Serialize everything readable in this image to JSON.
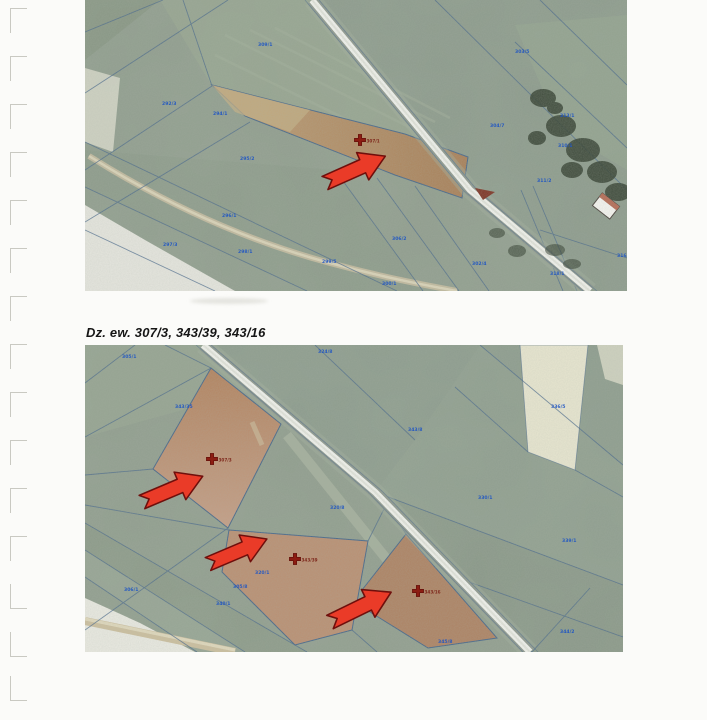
{
  "page": {
    "background": "#fbfbf9",
    "caption": "Dz. ew. 307/3, 343/39, 343/16"
  },
  "colors": {
    "field_green": "#8f9c8d",
    "boundary_blue": "#47678a",
    "parcel_number_blue": "#1e55c4",
    "highlight_brown": "#b5886a",
    "arrow_red": "#ea3b28",
    "arrow_outline": "#6f0f0c",
    "cross_dark_red": "#8c1d12",
    "road_white": "#f2f3ee"
  },
  "top_map": {
    "description": "aerial orthophoto with cadastral parcel boundaries, one highlighted parcel with red cross marker and red arrow",
    "markers": [
      {
        "label": "307/1",
        "x": 275,
        "y": 140
      }
    ],
    "arrows": [
      {
        "x": 240,
        "y": 183,
        "angle": -24,
        "len": 66
      }
    ],
    "parcel_labels": [
      {
        "t": "309/1",
        "x": 173,
        "y": 46
      },
      {
        "t": "294/1",
        "x": 128,
        "y": 115
      },
      {
        "t": "292/3",
        "x": 77,
        "y": 105
      },
      {
        "t": "295/2",
        "x": 155,
        "y": 160
      },
      {
        "t": "296/1",
        "x": 137,
        "y": 217
      },
      {
        "t": "297/3",
        "x": 78,
        "y": 246
      },
      {
        "t": "298/1",
        "x": 153,
        "y": 253
      },
      {
        "t": "299/5",
        "x": 237,
        "y": 263
      },
      {
        "t": "306/2",
        "x": 307,
        "y": 240
      },
      {
        "t": "300/1",
        "x": 297,
        "y": 285
      },
      {
        "t": "302/4",
        "x": 387,
        "y": 265
      },
      {
        "t": "318/1",
        "x": 465,
        "y": 275
      },
      {
        "t": "303/5",
        "x": 430,
        "y": 53
      },
      {
        "t": "313/1",
        "x": 475,
        "y": 117
      },
      {
        "t": "304/7",
        "x": 405,
        "y": 127
      },
      {
        "t": "310/1",
        "x": 473,
        "y": 147
      },
      {
        "t": "311/2",
        "x": 452,
        "y": 182
      },
      {
        "t": "316/1",
        "x": 532,
        "y": 257
      }
    ]
  },
  "bottom_map": {
    "description": "aerial orthophoto with cadastral parcel boundaries, three highlighted parcels with red cross markers and red arrows",
    "markers": [
      {
        "label": "307/3",
        "x": 127,
        "y": 114
      },
      {
        "label": "343/39",
        "x": 210,
        "y": 214
      },
      {
        "label": "343/16",
        "x": 333,
        "y": 246
      }
    ],
    "arrows": [
      {
        "x": 57,
        "y": 157,
        "angle": -23,
        "len": 66
      },
      {
        "x": 123,
        "y": 219,
        "angle": -23,
        "len": 64
      },
      {
        "x": 245,
        "y": 277,
        "angle": -26,
        "len": 68
      }
    ],
    "parcel_labels": [
      {
        "t": "305/1",
        "x": 37,
        "y": 13
      },
      {
        "t": "324/8",
        "x": 233,
        "y": 8
      },
      {
        "t": "343/35",
        "x": 90,
        "y": 63
      },
      {
        "t": "343/8",
        "x": 323,
        "y": 86
      },
      {
        "t": "336/5",
        "x": 466,
        "y": 63
      },
      {
        "t": "330/1",
        "x": 393,
        "y": 154
      },
      {
        "t": "339/1",
        "x": 477,
        "y": 197
      },
      {
        "t": "320/8",
        "x": 245,
        "y": 164
      },
      {
        "t": "320/1",
        "x": 170,
        "y": 229
      },
      {
        "t": "305/8",
        "x": 148,
        "y": 243
      },
      {
        "t": "340/1",
        "x": 131,
        "y": 260
      },
      {
        "t": "306/1",
        "x": 39,
        "y": 246
      },
      {
        "t": "344/2",
        "x": 475,
        "y": 288
      },
      {
        "t": "345/8",
        "x": 353,
        "y": 298
      }
    ]
  },
  "margin_marks": {
    "positions": [
      {
        "y": 8,
        "style": "G"
      },
      {
        "y": 56,
        "style": "G"
      },
      {
        "y": 104,
        "style": "G"
      },
      {
        "y": 152,
        "style": "G"
      },
      {
        "y": 200,
        "style": "G"
      },
      {
        "y": 248,
        "style": "G"
      },
      {
        "y": 296,
        "style": "G"
      },
      {
        "y": 344,
        "style": "G"
      },
      {
        "y": 392,
        "style": "G"
      },
      {
        "y": 440,
        "style": "G"
      },
      {
        "y": 488,
        "style": "G"
      },
      {
        "y": 536,
        "style": "G"
      },
      {
        "y": 584,
        "style": "L"
      },
      {
        "y": 632,
        "style": "L"
      },
      {
        "y": 676,
        "style": "L"
      }
    ]
  }
}
